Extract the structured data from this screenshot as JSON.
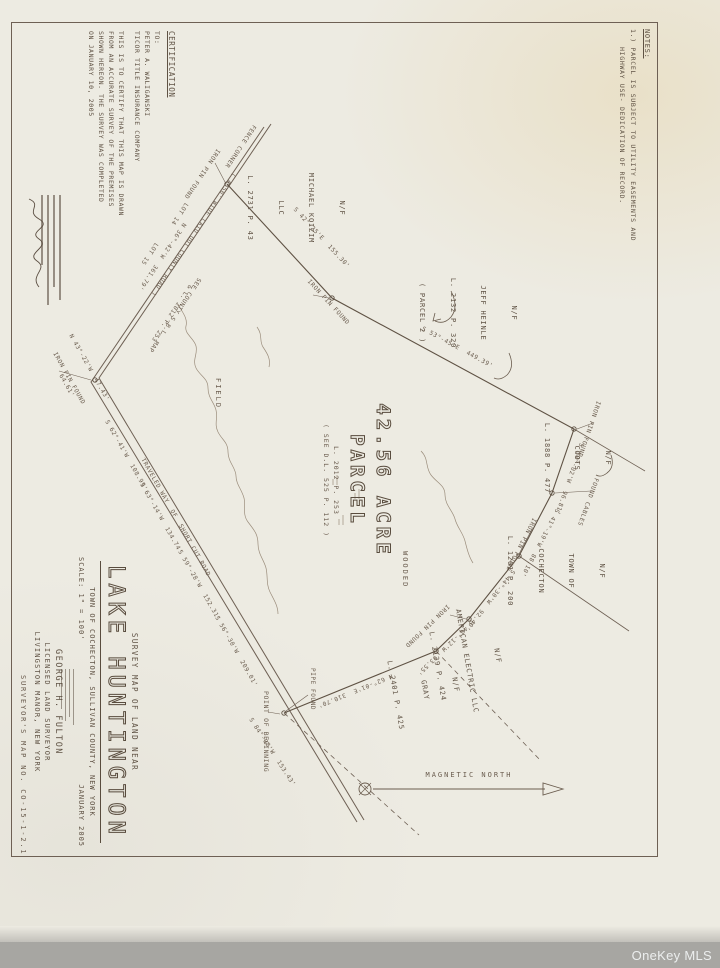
{
  "colors": {
    "ink": "#5b4e42",
    "paper": "#edebe2",
    "watermark_bar": "#a7a6a2"
  },
  "watermark": {
    "label": "OneKey MLS"
  },
  "notes": {
    "heading": "NOTES:",
    "item": "1.)  PARCEL IS SUBJECT TO UTILITY EASEMENTS AND",
    "item_cont": "HIGHWAY USE- DEDICATION OF RECORD."
  },
  "certification": {
    "heading": "CERTIFICATION",
    "to": "TO:",
    "line1": "PETER A. WALIGANSKI",
    "line2": "TICOR TITLE INSURANCE COMPANY",
    "body1": "THIS IS TO CERTIFY THAT THIS MAP IS DRAWN",
    "body2": "FROM AN ACCURATE SURVEY OF THE PREMISES",
    "body3": "SHOWN HEREON. THE SURVEY WAS COMPLETED",
    "body4": "ON JANUARY 10, 2005"
  },
  "parcel": {
    "acreage": "42.56 ACRE",
    "label": "PARCEL",
    "ref1": "L. 2012 P. 253",
    "ref2": "( SEE D.L. 525 P. 112 )"
  },
  "title_block": {
    "subtitle": "SURVEY MAP OF LAND NEAR",
    "title": "LAKE HUNTINGTON",
    "location": "TOWN OF COCHECTON, SULLIVAN COUNTY, NEW YORK",
    "scale": "SCALE: 1\" = 100'",
    "date": "JANUARY 2005",
    "surveyor_name": "GEORGE H. FULTON",
    "surveyor_title": "LICENSED LAND SURVEYOR",
    "surveyor_location": "LIVINGSTON MANOR, NEW YORK"
  },
  "map_number": "SURVEYOR'S MAP NO. CO-15-1-2.1",
  "north_arrow": {
    "label": "MAGNETIC NORTH"
  },
  "owners": [
    {
      "lines": [
        "N/F",
        "MICHAEL KOIZIM",
        "LLC",
        "L. 2731 P. 43"
      ]
    },
    {
      "lines": [
        "N/F",
        "JEFF HEINLE",
        "L. 2132 P. 320",
        "( PARCEL 2 )"
      ]
    },
    {
      "lines": [
        "N/F",
        "COOTS",
        "L. 1888 P. 477"
      ]
    },
    {
      "lines": [
        "N/F",
        "TOWN OF",
        "COCHECTON",
        "L. 1261 P. 200"
      ]
    },
    {
      "lines": [
        "N/F",
        "AMERICAN ELECTRIC LLC",
        "L. 2139 P. 424"
      ]
    },
    {
      "lines": [
        "N/F",
        "GRAY",
        "L. 2401 P. 425"
      ]
    }
  ],
  "roads": [
    {
      "name": "( A 50' WIDE LAID OUT COUNTY ROAD )"
    },
    {
      "name": "TRAVELED WAY  OF  SHORT CUT ROAD"
    }
  ],
  "bearings": [
    {
      "text": "S 62°-41'W  108.99'"
    },
    {
      "text": "S 63°-14'W  134.74'"
    },
    {
      "text": "S 59°-28'W  152.31'"
    },
    {
      "text": "S 56°-30'W  209.01'"
    },
    {
      "text": "S 84°-08'W  153.43'"
    },
    {
      "text": "N 36°-42'W  361.79'"
    },
    {
      "text": "N 43°-22'W  47.43'"
    },
    {
      "text": "64.61'"
    },
    {
      "text": "S 42°-25'E  155.30'"
    },
    {
      "text": "S 53°-45'E  449.39'"
    },
    {
      "text": "S 30°-02'W  96.81'"
    },
    {
      "text": "S 41°-19'W  88.10'"
    },
    {
      "text": "S 44°-30'W  92.40'"
    },
    {
      "text": "S 40°-12'W  63.55'"
    },
    {
      "text": "N 62°-01'E  310.70'"
    }
  ],
  "pins": [
    {
      "text": "IRON PIN FOUND"
    },
    {
      "text": "IRON PIN FOUND"
    },
    {
      "text": "IRON PIN FOUND"
    },
    {
      "text": "IRON PIN FOUND"
    },
    {
      "text": "IRON PIN FOUND"
    },
    {
      "text": "PIPE FOUND"
    },
    {
      "text": "IRON PIN FOUND"
    },
    {
      "text": "FOUND CABLES"
    }
  ],
  "features": {
    "field": "FIELD",
    "wooded": "WOODED",
    "pob": "POINT OF BEGINNING",
    "fence": "FENCE CORNER",
    "see1": "SEE COUNTY S.B.L. MAP",
    "see2": "& L. 2012 P. 253",
    "lot14": "LOT 14",
    "lot15": "LOT 15"
  }
}
